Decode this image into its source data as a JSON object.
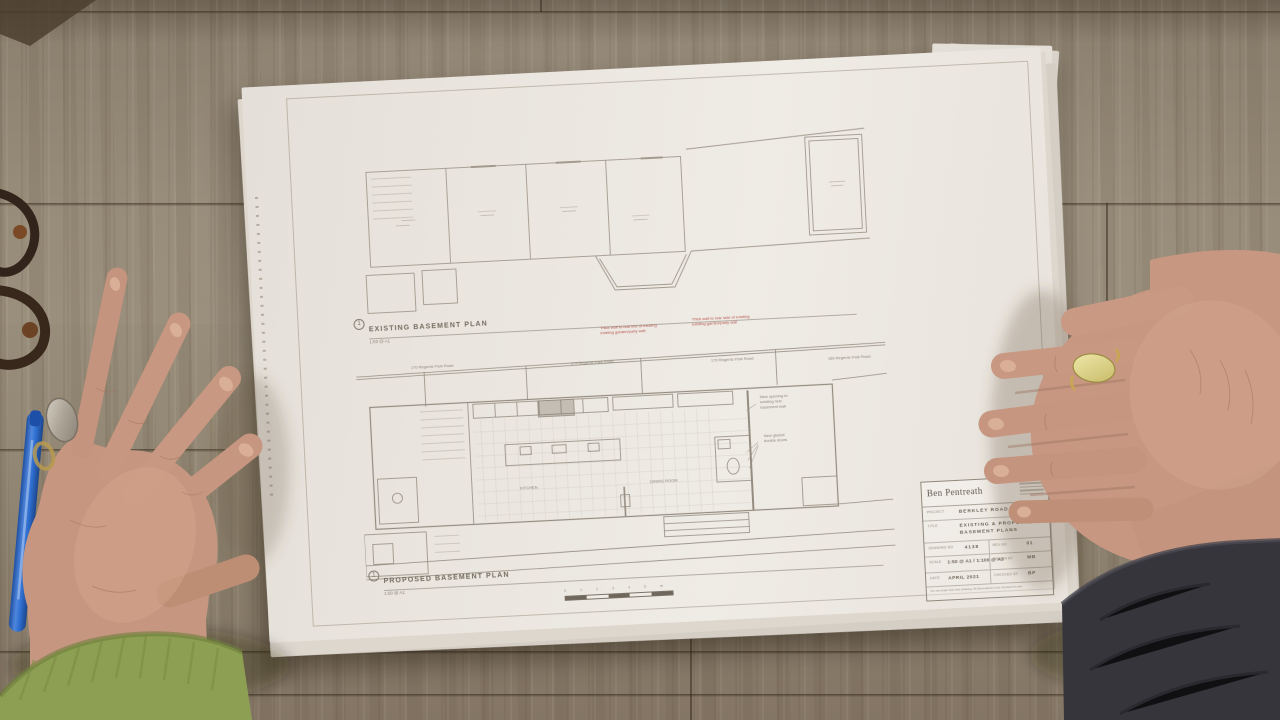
{
  "scene": {
    "type": "overhead-photo",
    "subject": "two hands holding architectural basement plans on a wooden table"
  },
  "sheet": {
    "brand": "Ben Pentreath",
    "existing_plan": {
      "marker": "1",
      "title": "EXISTING BASEMENT PLAN",
      "scale": "1:50 @ A1"
    },
    "proposed_plan": {
      "marker": "1",
      "title": "PROPOSED BASEMENT PLAN",
      "scale": "1:50 @ A1"
    },
    "street_labels": [
      "170 Regents Park Road",
      "174 Regents Park Road",
      "176 Regents Park Road",
      "180 Regents Park Road"
    ],
    "red_notes": [
      {
        "line1": "Thick wall to rear line of existing",
        "line2": "existing garden/party wall"
      },
      {
        "line1": "Thick wall to rear side of existing",
        "line2": "existing garden/party wall"
      }
    ],
    "annotations": [
      {
        "line1": "New opening to",
        "line2": "existing rear",
        "line3": "basement wall"
      },
      {
        "line1": "New glazed",
        "line2": "double doors"
      }
    ],
    "room_labels": {
      "kitchen": "KITCHEN",
      "dining": "DINING ROOM"
    },
    "scale_bar": {
      "ticks": [
        "0",
        "1",
        "2",
        "3",
        "4",
        "5"
      ],
      "unit": "m"
    },
    "title_block": {
      "project_label": "PROJECT",
      "project_value": "BERKLEY ROAD",
      "title_label": "TITLE",
      "title_value_1": "EXISTING & PROPOSED",
      "title_value_2": "BASEMENT PLANS",
      "drawing_no_label": "DRAWING NO",
      "drawing_no_value": "4138",
      "rev_label": "REV NO",
      "rev_value": "01",
      "scale_label": "SCALE",
      "scale_value": "1:50 @ A1 / 1:100 @ A3",
      "drawn_label": "DRAWN BY",
      "drawn_value": "MB",
      "date_label": "DATE",
      "date_value": "APRIL 2021",
      "checked_label": "CHECKED BY",
      "checked_value": "BP",
      "fine_print": "Do not scale from this drawing. All dimensions to be checked on site."
    }
  },
  "colors": {
    "paper": "#ece8e2",
    "red_note": "#b5544c",
    "pen_blue": "#2f6fd0",
    "sleeve_green": "#8d9f52",
    "sleeve_dark": "#36353b",
    "wood": "#948876"
  }
}
